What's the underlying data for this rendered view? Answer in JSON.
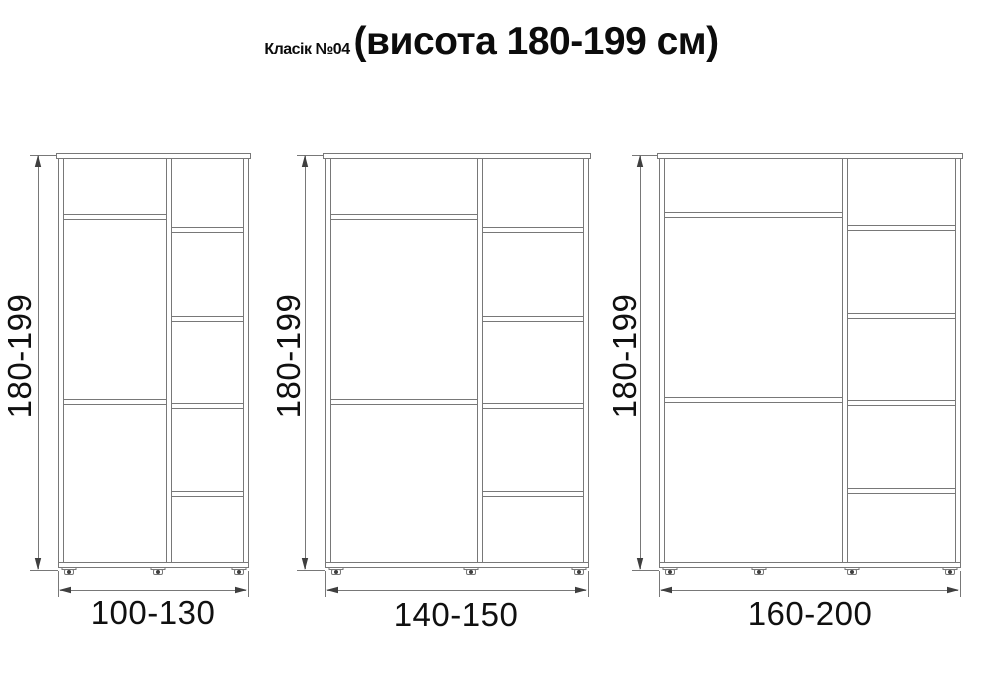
{
  "title": {
    "main": "Класік №04",
    "suffix": "(висота 180-199 см)"
  },
  "diagram": {
    "line_color": "#787878",
    "arrow_color": "#3f3f3f",
    "foot_color": "#3f3f3f",
    "background": "#ffffff",
    "height_unit": "см",
    "cabinets": [
      {
        "id": "wardrobe-100-130",
        "height_label": "180-199",
        "width_label": "100-130",
        "box": {
          "x": 58,
          "y": 153,
          "w": 190,
          "h": 414
        },
        "panel_thickness": 5,
        "divider_x": 166,
        "left_shelves_y": [
          214,
          399
        ],
        "right_shelves_y": [
          227,
          316,
          403,
          491
        ],
        "feet_x": [
          69,
          158,
          239
        ],
        "v_dim_x": 38,
        "h_dim_y": 590,
        "floor_y": 570
      },
      {
        "id": "wardrobe-140-150",
        "height_label": "180-199",
        "width_label": "140-150",
        "box": {
          "x": 325,
          "y": 153,
          "w": 263,
          "h": 414
        },
        "panel_thickness": 5,
        "divider_x": 477,
        "left_shelves_y": [
          214,
          399
        ],
        "right_shelves_y": [
          227,
          316,
          403,
          491
        ],
        "feet_x": [
          336,
          471,
          579
        ],
        "v_dim_x": 305,
        "h_dim_y": 590,
        "floor_y": 570
      },
      {
        "id": "wardrobe-160-200",
        "height_label": "180-199",
        "width_label": "160-200",
        "box": {
          "x": 659,
          "y": 153,
          "w": 301,
          "h": 414
        },
        "panel_thickness": 5,
        "divider_x": 842,
        "left_shelves_y": [
          212,
          397
        ],
        "right_shelves_y": [
          225,
          313,
          400,
          488
        ],
        "feet_x": [
          670,
          759,
          852,
          950
        ],
        "v_dim_x": 640,
        "h_dim_y": 590,
        "floor_y": 570
      }
    ]
  }
}
